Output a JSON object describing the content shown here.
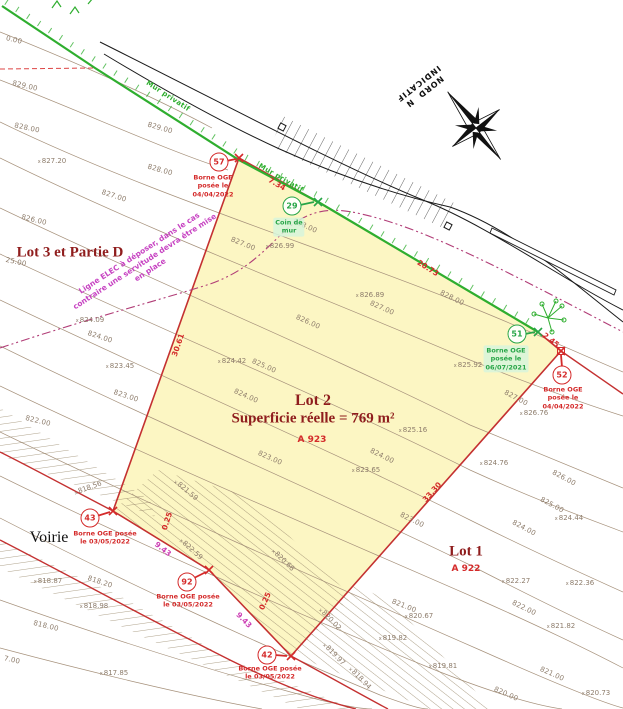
{
  "colors": {
    "lot_fill": "#fcf6c3",
    "boundary_red": "#c43131",
    "survey_red": "#d42a2a",
    "wall_green": "#2fae2f",
    "note_green": "#27a547",
    "magenta": "#cc3fb4",
    "elec_pink": "#c743c2",
    "contour_brown": "#a6917b",
    "title_darkred": "#8f1d1d",
    "road_black": "#1a1a1a"
  },
  "compass": {
    "line1": "NORD",
    "n": "N",
    "line2": "INDICATIF"
  },
  "lots": {
    "lot3": {
      "title": "Lot 3 et Partie D"
    },
    "lot2": {
      "title": "Lot 2",
      "area": "Superficie réelle = 769 m²",
      "parcel": "A 923"
    },
    "lot1": {
      "title": "Lot 1",
      "parcel": "A 922"
    },
    "road": {
      "label": "Voirie"
    }
  },
  "elec_note": {
    "lines": [
      "Ligne ELEC à déposer, dans le cas",
      "contraire une servitude devra être mise",
      "en place"
    ]
  },
  "wall_labels": [
    {
      "text": "Mur privatif",
      "x": 168,
      "y": 96,
      "rot": 33
    },
    {
      "text": "Mur privatif",
      "x": 281,
      "y": 178,
      "rot": 30
    }
  ],
  "markers": [
    {
      "id": "57",
      "color": "red",
      "cx": 219,
      "cy": 162,
      "nx": 213,
      "ny": 186,
      "note": [
        "Borne OGE",
        "posée le",
        "04/04/2022"
      ]
    },
    {
      "id": "29",
      "color": "green",
      "cx": 292,
      "cy": 206,
      "nx": 289,
      "ny": 227,
      "note": [
        "Coin de",
        "mur"
      ]
    },
    {
      "id": "51",
      "color": "green",
      "cx": 517,
      "cy": 334,
      "nx": 506,
      "ny": 359,
      "note": [
        "Borne OGE",
        "posée le",
        "06/07/2021"
      ]
    },
    {
      "id": "52",
      "color": "red",
      "cx": 562,
      "cy": 375,
      "nx": 563,
      "ny": 398,
      "note": [
        "Borne OGE",
        "posée le",
        "04/04/2022"
      ]
    },
    {
      "id": "43",
      "color": "red",
      "cx": 90,
      "cy": 518,
      "nx": 105,
      "ny": 538,
      "note": [
        "Borne OGE posée",
        "le 03/05/2022"
      ]
    },
    {
      "id": "92",
      "color": "red",
      "cx": 187,
      "cy": 582,
      "nx": 188,
      "ny": 601,
      "note": [
        "Borne OGE posée",
        "le 03/05/2022"
      ]
    },
    {
      "id": "42",
      "color": "red",
      "cx": 267,
      "cy": 655,
      "nx": 270,
      "ny": 673,
      "note": [
        "Borne OGE posée",
        "le 03/05/2022"
      ]
    }
  ],
  "measurements": [
    {
      "t": "7.34",
      "x": 277,
      "y": 184,
      "r": 30,
      "c": "red"
    },
    {
      "t": "20.73",
      "x": 428,
      "y": 268,
      "r": 32,
      "c": "red"
    },
    {
      "t": "30.61",
      "x": 178,
      "y": 345,
      "r": -71,
      "c": "red"
    },
    {
      "t": "33.30",
      "x": 432,
      "y": 492,
      "r": -48,
      "c": "red"
    },
    {
      "t": "2.45",
      "x": 551,
      "y": 340,
      "r": 38,
      "c": "red"
    },
    {
      "t": "9.43",
      "x": 163,
      "y": 549,
      "r": 38,
      "c": "magenta"
    },
    {
      "t": "9.43",
      "x": 244,
      "y": 620,
      "r": 46,
      "c": "magenta"
    },
    {
      "t": "0.25",
      "x": 167,
      "y": 521,
      "r": -72,
      "c": "red"
    },
    {
      "t": "0.25",
      "x": 265,
      "y": 601,
      "r": -66,
      "c": "red"
    }
  ],
  "contour_labels": [
    {
      "t": "0.00",
      "x": 14,
      "y": 40,
      "r": 14
    },
    {
      "t": "829.00",
      "x": 25,
      "y": 86,
      "r": 13
    },
    {
      "t": "828.00",
      "x": 27,
      "y": 128,
      "r": 12
    },
    {
      "t": "829.00",
      "x": 160,
      "y": 128,
      "r": 16
    },
    {
      "t": "828.00",
      "x": 160,
      "y": 170,
      "r": 16
    },
    {
      "t": "827.00",
      "x": 114,
      "y": 196,
      "r": 18
    },
    {
      "t": "826.00",
      "x": 34,
      "y": 220,
      "r": 14
    },
    {
      "t": "25.00",
      "x": 16,
      "y": 262,
      "r": 12
    },
    {
      "t": "824.00",
      "x": 100,
      "y": 337,
      "r": 18
    },
    {
      "t": "823.00",
      "x": 126,
      "y": 396,
      "r": 18
    },
    {
      "t": "822.00",
      "x": 38,
      "y": 421,
      "r": 14
    },
    {
      "t": "818.00",
      "x": 46,
      "y": 626,
      "r": 14
    },
    {
      "t": "7.00",
      "x": 12,
      "y": 660,
      "r": 12
    },
    {
      "t": "818.20",
      "x": 100,
      "y": 582,
      "r": 18
    },
    {
      "t": "828.00",
      "x": 305,
      "y": 226,
      "r": 24
    },
    {
      "t": "827.00",
      "x": 243,
      "y": 244,
      "r": 22
    },
    {
      "t": "826.00",
      "x": 308,
      "y": 322,
      "r": 24
    },
    {
      "t": "828.00",
      "x": 452,
      "y": 298,
      "r": 26
    },
    {
      "t": "827.00",
      "x": 382,
      "y": 308,
      "r": 24
    },
    {
      "t": "825.00",
      "x": 264,
      "y": 366,
      "r": 24
    },
    {
      "t": "824.00",
      "x": 246,
      "y": 396,
      "r": 24
    },
    {
      "t": "823.00",
      "x": 270,
      "y": 458,
      "r": 24
    },
    {
      "t": "824.00",
      "x": 382,
      "y": 456,
      "r": 26
    },
    {
      "t": "827.00",
      "x": 516,
      "y": 398,
      "r": 28
    },
    {
      "t": "826.00",
      "x": 564,
      "y": 478,
      "r": 28
    },
    {
      "t": "825.00",
      "x": 552,
      "y": 505,
      "r": 28
    },
    {
      "t": "823.00",
      "x": 412,
      "y": 520,
      "r": 26
    },
    {
      "t": "824.00",
      "x": 524,
      "y": 528,
      "r": 28
    },
    {
      "t": "821.00",
      "x": 404,
      "y": 606,
      "r": 22
    },
    {
      "t": "822.00",
      "x": 524,
      "y": 608,
      "r": 26
    },
    {
      "t": "820.00",
      "x": 506,
      "y": 694,
      "r": 24
    },
    {
      "t": "821.00",
      "x": 552,
      "y": 674,
      "r": 24
    }
  ],
  "spot_heights": [
    {
      "t": "827.20",
      "x": 52,
      "y": 161,
      "r": 0
    },
    {
      "t": "826.99",
      "x": 280,
      "y": 246,
      "r": 0
    },
    {
      "t": "826.89",
      "x": 370,
      "y": 295,
      "r": 0
    },
    {
      "t": "824.09",
      "x": 90,
      "y": 320,
      "r": 0
    },
    {
      "t": "823.45",
      "x": 120,
      "y": 366,
      "r": 0
    },
    {
      "t": "824.42",
      "x": 232,
      "y": 361,
      "r": 0
    },
    {
      "t": "825.16",
      "x": 413,
      "y": 430,
      "r": 0
    },
    {
      "t": "823.65",
      "x": 366,
      "y": 470,
      "r": 0
    },
    {
      "t": "826.76",
      "x": 534,
      "y": 413,
      "r": 0
    },
    {
      "t": "825.92",
      "x": 468,
      "y": 365,
      "r": 0
    },
    {
      "t": "824.76",
      "x": 494,
      "y": 463,
      "r": 0
    },
    {
      "t": "824.44",
      "x": 569,
      "y": 518,
      "r": 0
    },
    {
      "t": "822.27",
      "x": 516,
      "y": 581,
      "r": 0
    },
    {
      "t": "822.36",
      "x": 580,
      "y": 583,
      "r": 0
    },
    {
      "t": "820.67",
      "x": 419,
      "y": 616,
      "r": 0
    },
    {
      "t": "821.82",
      "x": 561,
      "y": 626,
      "r": 0
    },
    {
      "t": "819.82",
      "x": 393,
      "y": 638,
      "r": 0
    },
    {
      "t": "819.81",
      "x": 443,
      "y": 666,
      "r": 0
    },
    {
      "t": "820.73",
      "x": 596,
      "y": 693,
      "r": 0
    },
    {
      "t": "818.87",
      "x": 48,
      "y": 581,
      "r": 0
    },
    {
      "t": "818.98",
      "x": 94,
      "y": 606,
      "r": 0
    },
    {
      "t": "817.85",
      "x": 114,
      "y": 673,
      "r": 0
    },
    {
      "t": "818.56",
      "x": 88,
      "y": 488,
      "r": -20
    },
    {
      "t": "821.59",
      "x": 186,
      "y": 490,
      "r": 40
    },
    {
      "t": "822.59",
      "x": 191,
      "y": 549,
      "r": 42
    },
    {
      "t": "820.68",
      "x": 283,
      "y": 560,
      "r": 44
    },
    {
      "t": "820.02",
      "x": 330,
      "y": 619,
      "r": 46
    },
    {
      "t": "819.97",
      "x": 334,
      "y": 654,
      "r": 46
    },
    {
      "t": "818.94",
      "x": 360,
      "y": 678,
      "r": 46
    }
  ]
}
